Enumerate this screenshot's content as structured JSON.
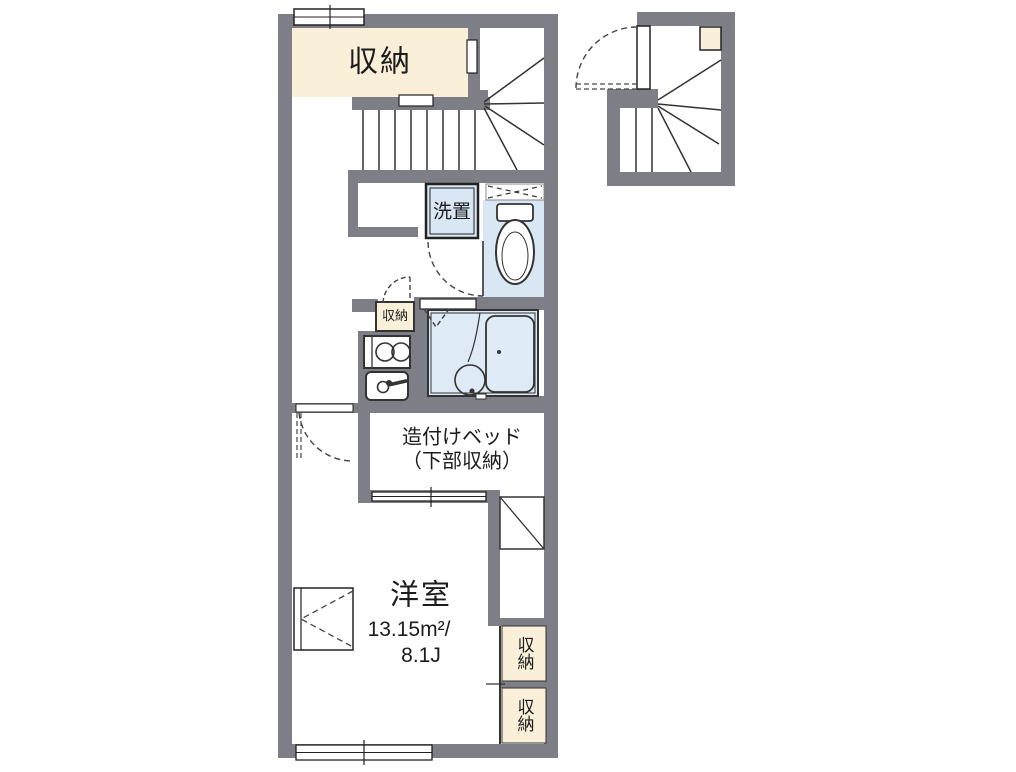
{
  "colors": {
    "background": "#ffffff",
    "wall": "#7e7e86",
    "storage_fill": "#faf0d9",
    "wet_area_fill": "#d9e6f4",
    "bath_fill": "#dfeaf7",
    "outline": "#1c1c1c"
  },
  "floorplan": {
    "labels": {
      "storage_top": "収納",
      "washer_stand": "洗置",
      "storage_small": "収納",
      "bed_line1": "造付けベッド",
      "bed_line2": "（下部収納）",
      "room_name": "洋室",
      "room_area_sqm": "13.15m²/",
      "room_area_tatami": "8.1J",
      "storage_right_upper": "収納",
      "storage_right_lower": "収納"
    }
  }
}
